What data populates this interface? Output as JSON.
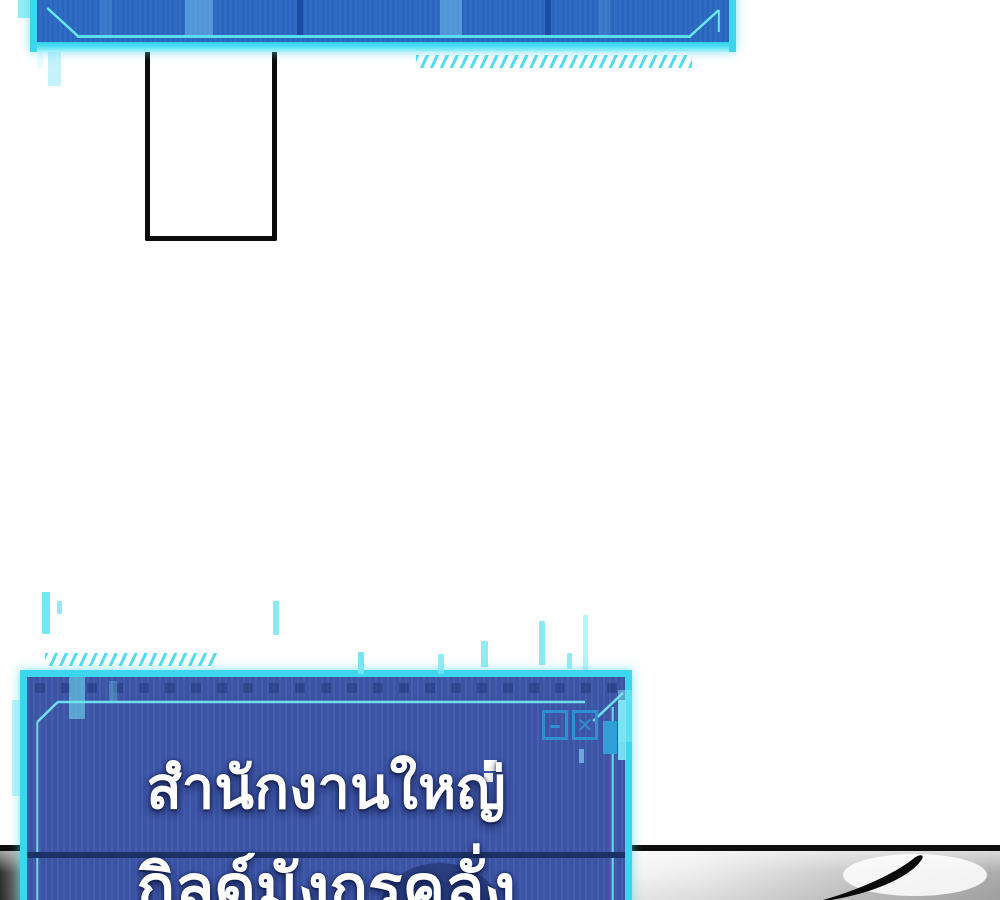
{
  "colors": {
    "accent_cyan": "#3cd7ef",
    "glow_cyan": "#aef3fb",
    "top_window_fill": "#2f6cc4",
    "bottom_window_fill": "#3b54a6",
    "icon_blue": "#2f8fd0",
    "panel_line_black": "#0e0e0e",
    "panel_line_navy": "#1b3364",
    "text_color": "#ffffff"
  },
  "bottom_window": {
    "line1": "สำนักงานใหญ่",
    "line2": "กิลด์มังกรคลั่ง",
    "controls": {
      "minimize": "–",
      "close": "✕"
    }
  }
}
